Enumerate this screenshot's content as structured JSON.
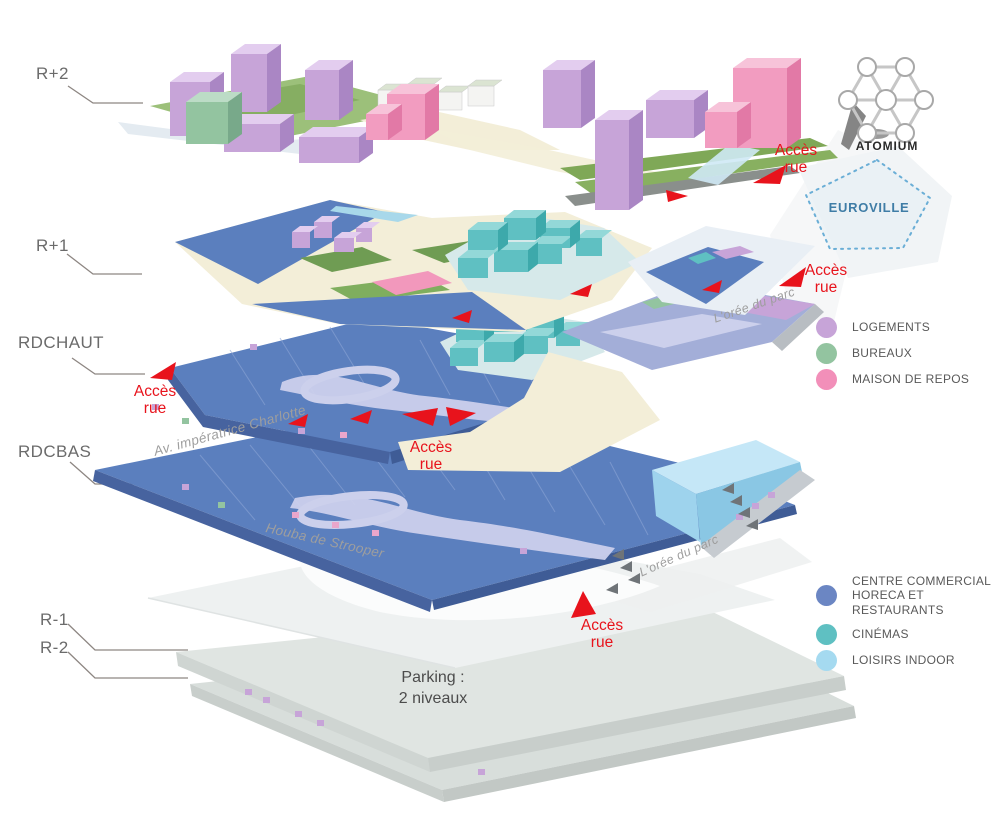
{
  "levels": {
    "r_plus_2": "R+2",
    "r_plus_1": "R+1",
    "rdc_haut_1": "RDC",
    "rdc_haut_2": "HAUT",
    "rdc_bas_1": "RDC",
    "rdc_bas_2": "BAS",
    "r_minus_1": "R-1",
    "r_minus_2": "R-2"
  },
  "access": {
    "line1": "Accès",
    "line2": "rue"
  },
  "streets": {
    "imperatrice": "Av. impératrice Charlotte",
    "houba": "Houba de Strooper",
    "oree_du_parc": "L'orée du parc"
  },
  "landmarks": {
    "atomium": "ATOMIUM",
    "euroville": "EUROVILLE"
  },
  "parking": {
    "line1": "Parking :",
    "line2": "2 niveaux"
  },
  "legend_upper": [
    {
      "label": "LOGEMENTS",
      "color": "#c7a4d8"
    },
    {
      "label": "BUREAUX",
      "color": "#93c4a0"
    },
    {
      "label": "MAISON DE REPOS",
      "color": "#f28fb9"
    }
  ],
  "legend_lower": [
    {
      "label": "CENTRE COMMERCIAL",
      "label2": "HORECA ET RESTAURANTS",
      "color": "#6b86c3"
    },
    {
      "label": "CINÉMAS",
      "color": "#5fc0c2"
    },
    {
      "label": "LOISIRS INDOOR",
      "color": "#a5daf0"
    }
  ],
  "palette": {
    "commercial_blue": "#5b7fbe",
    "cinema_teal": "#5fc0c2",
    "loisirs_light_blue": "#a5daf0",
    "logements_purple": "#c7a4d8",
    "bureaux_green": "#93c4a0",
    "repos_pink": "#f28fb9",
    "accent_red": "#e8131c",
    "euroville_blue": "#3f7da6",
    "level_label_gray": "#6b6b6b",
    "street_label_gray": "#9e9e9e"
  }
}
